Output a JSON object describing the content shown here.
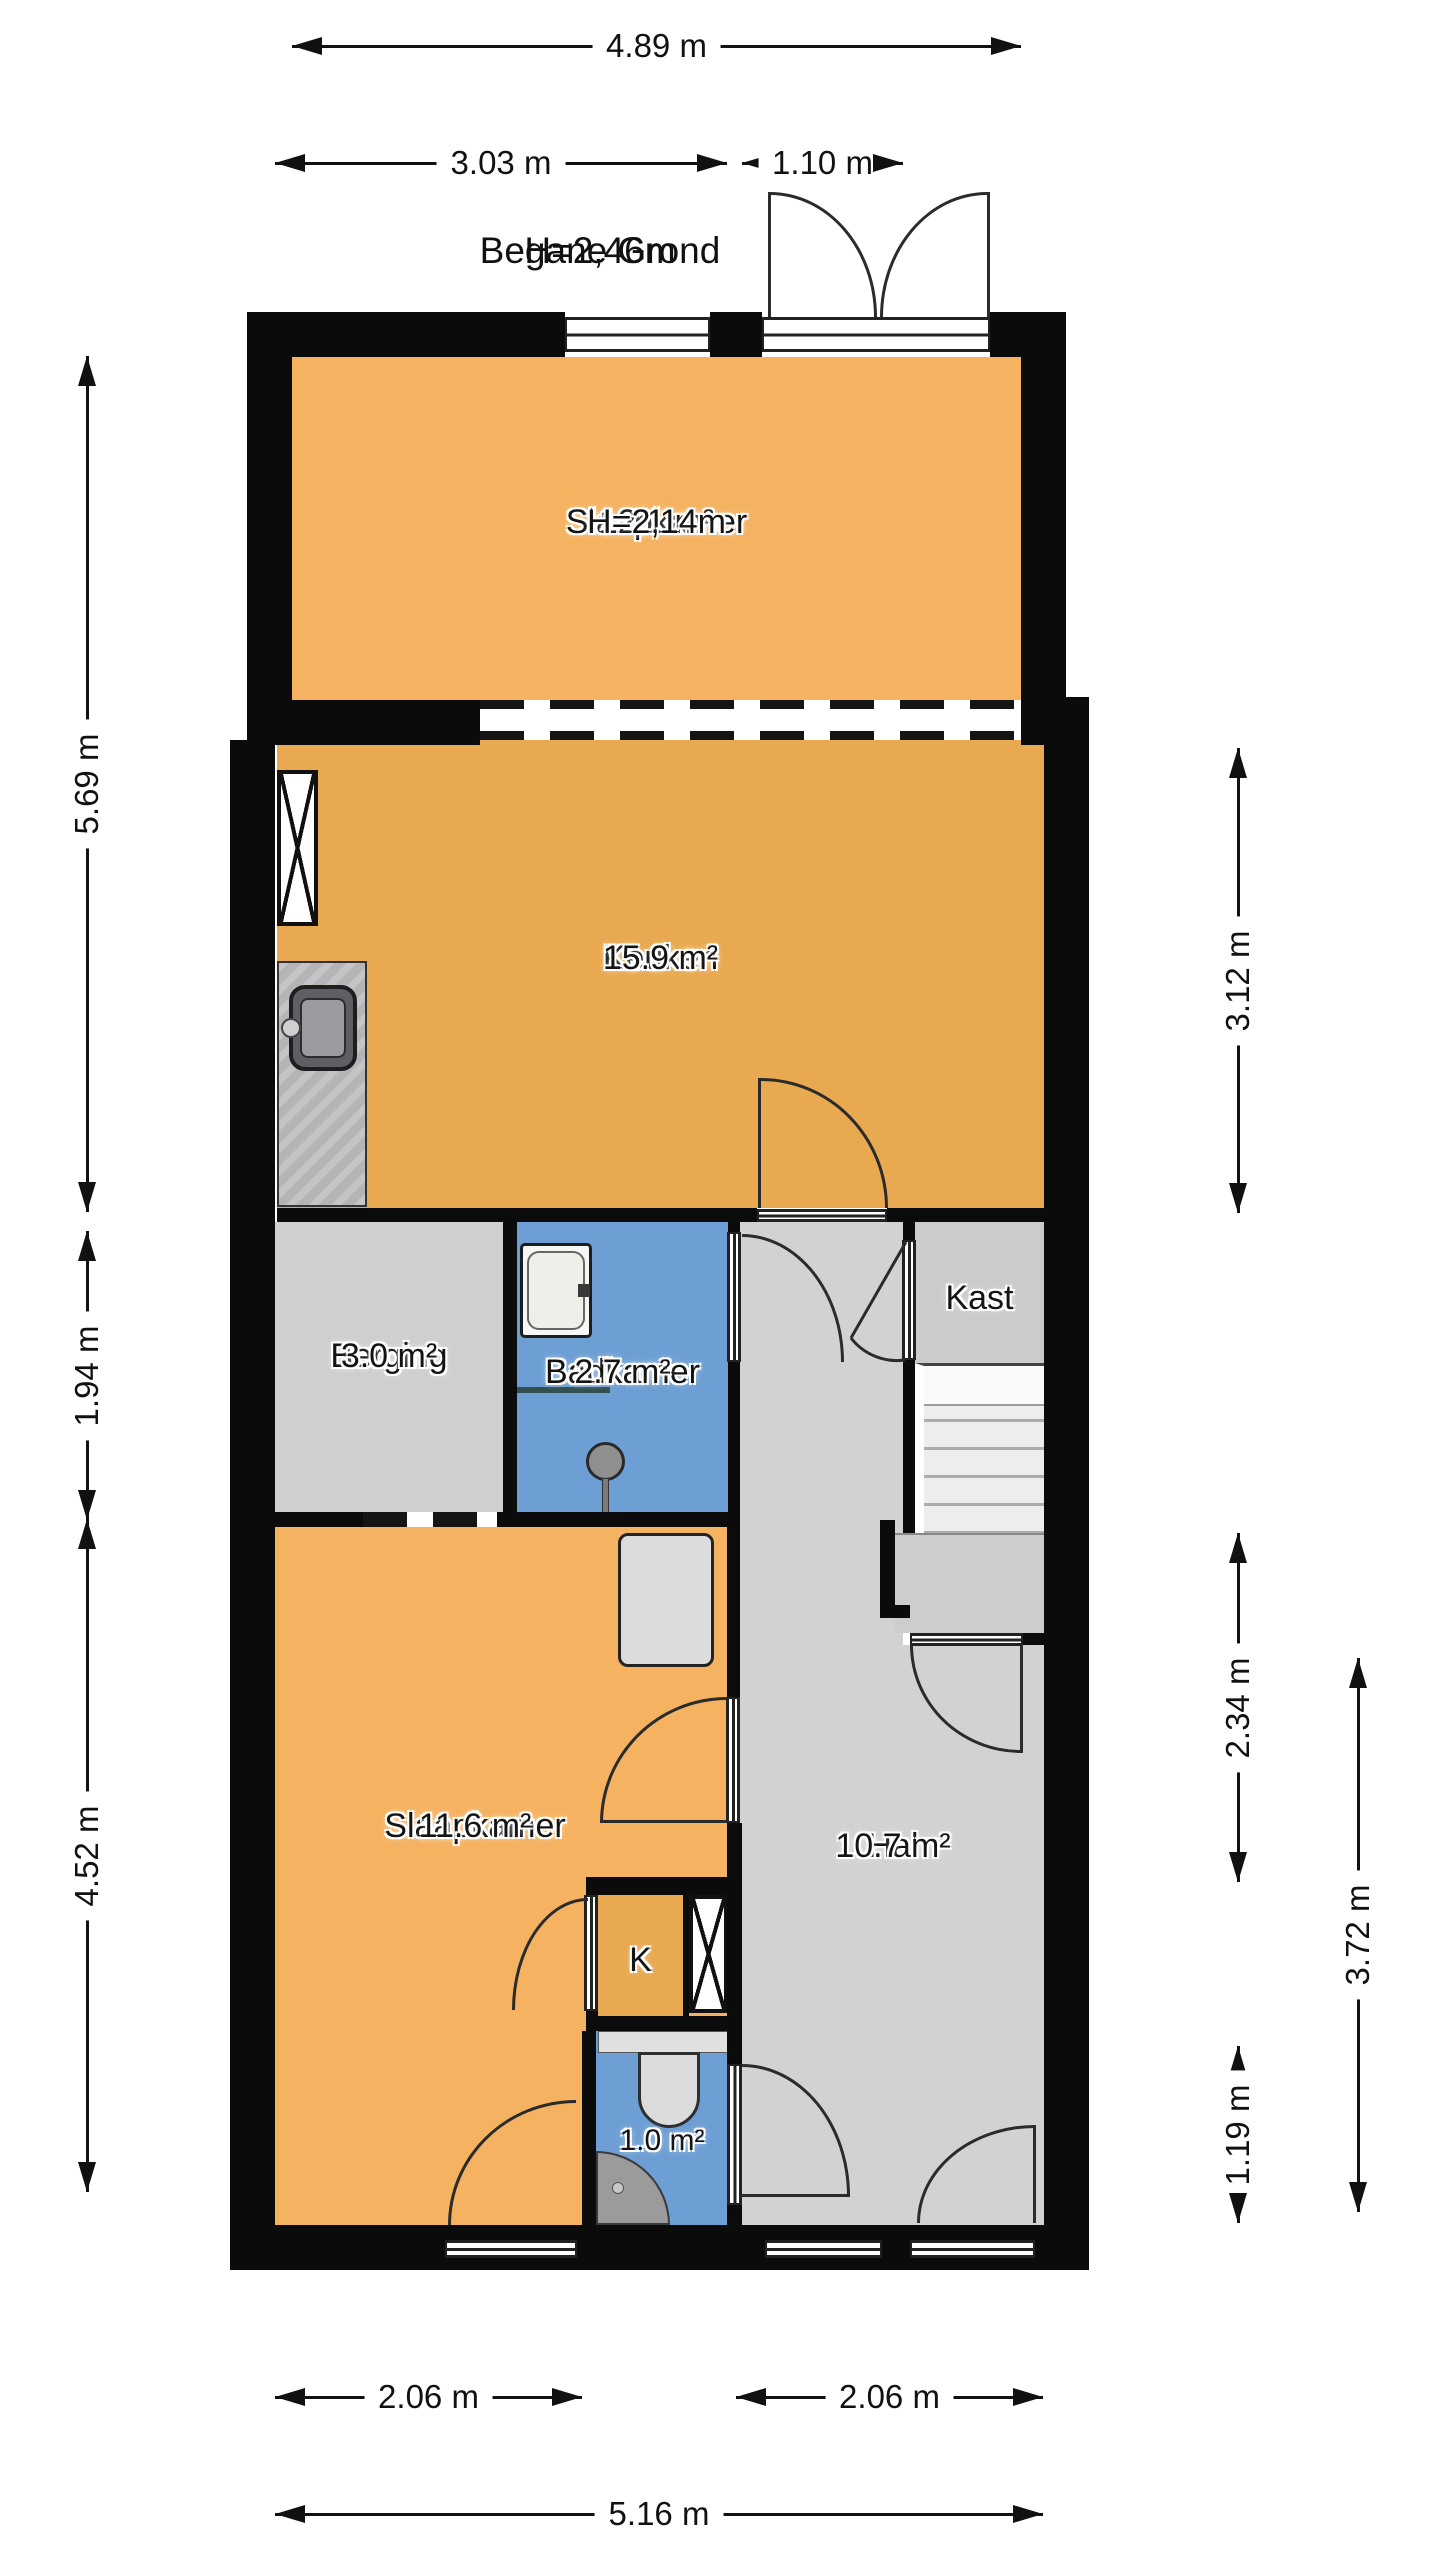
{
  "title": {
    "floor": "Begane Grond",
    "ceiling_height": "H=2,46m"
  },
  "rooms": {
    "slaapkamer_top": {
      "name": "Slaapkamer",
      "area": "12.1 m²",
      "height": "H=2,14m"
    },
    "keuken": {
      "name": "Keuken",
      "area": "15.9 m²"
    },
    "berging": {
      "name": "Berging",
      "area": "3.0 m²"
    },
    "badkamer": {
      "name": "Badkamer",
      "area": "2.7 m²"
    },
    "kast": {
      "name": "Kast"
    },
    "slaapkamer_bottom": {
      "name": "Slaapkamer",
      "area": "11.6 m²"
    },
    "hal": {
      "name": "Hal",
      "area": "10.7 m²"
    },
    "kast_k": {
      "name": "K"
    },
    "toilet": {
      "area": "1.0 m²"
    }
  },
  "dimensions": {
    "top_total": "4.89 m",
    "top_left": "3.03 m",
    "top_right": "1.10 m",
    "left_upper": "5.69 m",
    "left_middle": "1.94 m",
    "left_lower": "4.52 m",
    "right_upper": "3.12 m",
    "right_middle": "2.34 m",
    "right_outer": "3.72 m",
    "right_lower": "1.19 m",
    "bottom_left": "2.06 m",
    "bottom_right": "2.06 m",
    "bottom_total": "5.16 m"
  },
  "colors": {
    "room_orange": "#F5B261",
    "kitchen_orange": "#E9A950",
    "room_gray": "#D2D2D2",
    "wet_blue": "#6E9FD4",
    "wall_black": "#0B0B0B"
  }
}
